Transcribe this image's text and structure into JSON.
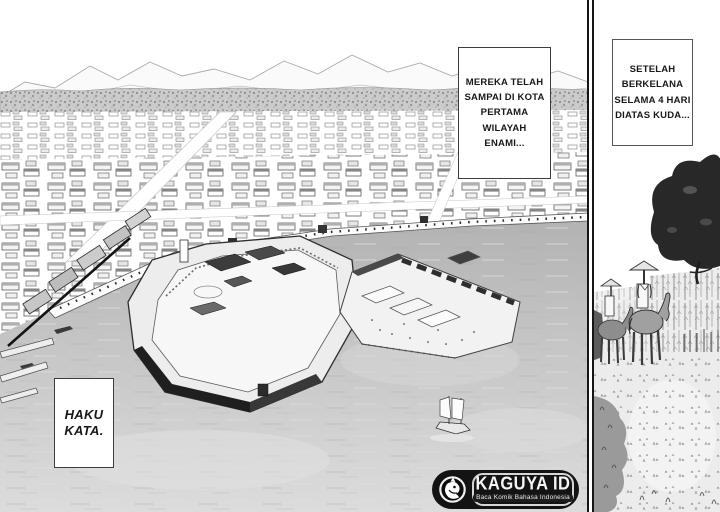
{
  "captions": {
    "box1": "MEREKA TELAH\nSAMPAI DI KOTA\nPERTAMA WILAYAH\nENAMI...",
    "box2": "SETELAH\nBERKELANA\nSELAMA 4 HARI\nDIATAS KUDA...",
    "box3": "HAKU\nKATA."
  },
  "watermark": {
    "brand": "KAGUYA ID",
    "tagline": "Baca Komik Bahasa Indonesia",
    "icon": "kaguya-rabbit-icon"
  },
  "colors": {
    "ink": "#1a1a1a",
    "water": "#c2c2c2",
    "badge_background": "#131313",
    "badge_border": "#d6d6d6",
    "caption_border": "#3c3c3c"
  },
  "scene": {
    "main_panel": [
      "mountain-range",
      "tree-line",
      "town-buildings",
      "harbor-water",
      "castle-fort",
      "warehouse-island",
      "wharf-wall",
      "piers",
      "sailboat"
    ],
    "side_panel": [
      "large-tree",
      "forest-band",
      "horse-riders",
      "fence-posts",
      "grass-field"
    ]
  }
}
